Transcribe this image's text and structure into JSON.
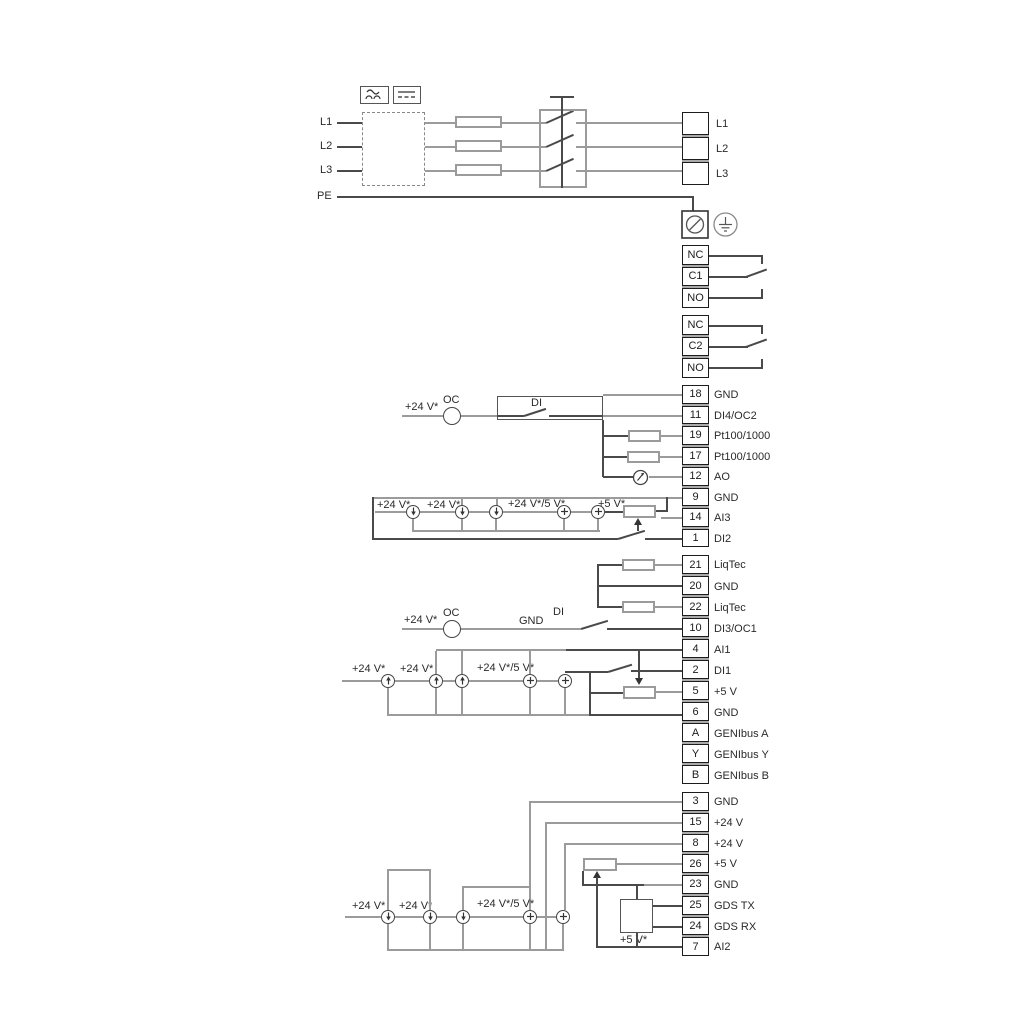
{
  "power": {
    "inputs": [
      "L1",
      "L2",
      "L3"
    ],
    "pe": "PE",
    "mains": [
      "L1",
      "L2",
      "L3"
    ]
  },
  "relays": {
    "r1": {
      "cells": [
        "NC",
        "C1",
        "NO"
      ]
    },
    "r2": {
      "cells": [
        "NC",
        "C2",
        "NO"
      ]
    }
  },
  "io1": {
    "cells": [
      {
        "num": "18",
        "label": "GND"
      },
      {
        "num": "11",
        "label": "DI4/OC2"
      },
      {
        "num": "19",
        "label": "Pt100/1000"
      },
      {
        "num": "17",
        "label": "Pt100/1000"
      },
      {
        "num": "12",
        "label": "AO"
      },
      {
        "num": "9",
        "label": "GND"
      },
      {
        "num": "14",
        "label": "AI3"
      },
      {
        "num": "1",
        "label": "DI2"
      }
    ]
  },
  "io2": {
    "cells": [
      {
        "num": "21",
        "label": "LiqTec"
      },
      {
        "num": "20",
        "label": "GND"
      },
      {
        "num": "22",
        "label": "LiqTec"
      },
      {
        "num": "10",
        "label": "DI3/OC1"
      },
      {
        "num": "4",
        "label": "AI1"
      },
      {
        "num": "2",
        "label": "DI1"
      },
      {
        "num": "5",
        "label": "+5 V"
      },
      {
        "num": "6",
        "label": "GND"
      },
      {
        "num": "A",
        "label": "GENIbus A"
      },
      {
        "num": "Y",
        "label": "GENIbus Y"
      },
      {
        "num": "B",
        "label": "GENIbus B"
      }
    ]
  },
  "io3": {
    "cells": [
      {
        "num": "3",
        "label": "GND"
      },
      {
        "num": "15",
        "label": "+24 V"
      },
      {
        "num": "8",
        "label": "+24 V"
      },
      {
        "num": "26",
        "label": "+5 V"
      },
      {
        "num": "23",
        "label": "GND"
      },
      {
        "num": "25",
        "label": "GDS TX"
      },
      {
        "num": "24",
        "label": "GDS RX"
      },
      {
        "num": "7",
        "label": "AI2"
      }
    ]
  },
  "ann": {
    "v24": "+24 V*",
    "v24v5": "+24 V*/5 V*",
    "v5": "+5 V*",
    "oc": "OC",
    "di": "DI",
    "gnd": "GND"
  },
  "icons": {
    "ac": "ac-waveform-icon",
    "dc": "dc-icon",
    "pe_terminal": "pe-screw-terminal-icon",
    "earth": "earth-ground-icon",
    "current_source": "current-source-icon",
    "voltage_source": "plus-source-icon",
    "meter": "analog-output-meter-icon",
    "fuse": "fuse-symbol",
    "contactor": "contactor-symbol",
    "potentiometer": "potentiometer-symbol",
    "resistor": "sensor-resistor-symbol"
  }
}
